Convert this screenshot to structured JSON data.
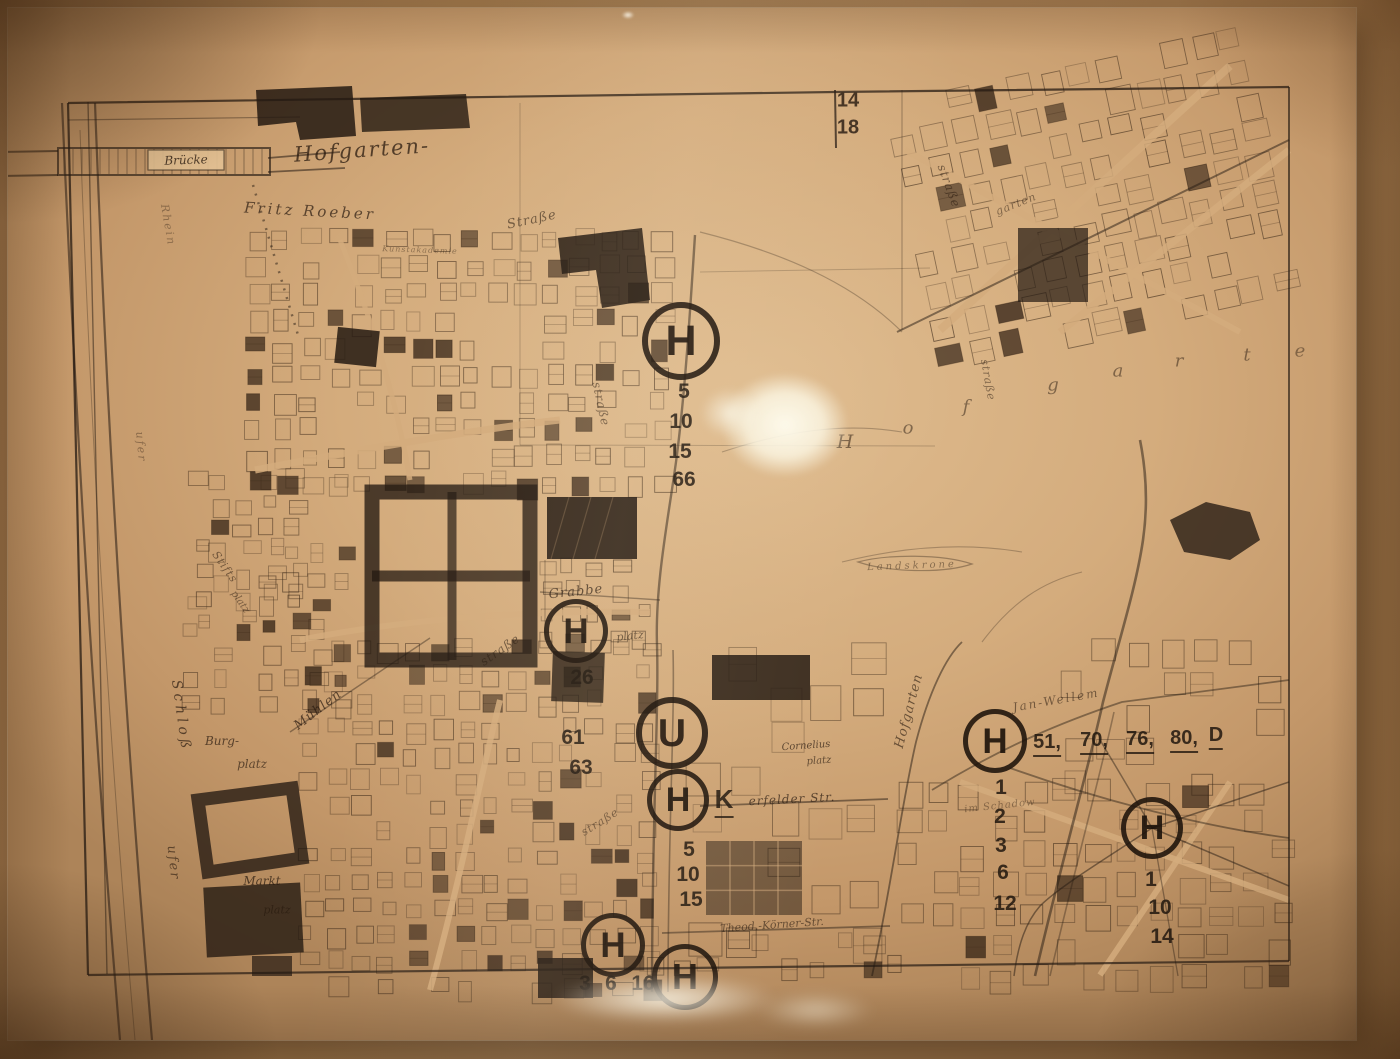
{
  "photo": {
    "colors": {
      "backdrop": "#b08757",
      "paper": "#d4ac7d",
      "paper_light": "#e2c093",
      "ink": "#241a12",
      "ink_faint": "#3a2818",
      "glare": "#fdf8e8"
    }
  },
  "map": {
    "sheet_corner_numbers": [
      "14",
      "18"
    ],
    "stops": [
      {
        "id": "h-hofgarten-north",
        "sym": "H",
        "x": 681,
        "y": 341,
        "r": 33,
        "lines": [
          {
            "t": "5",
            "x": 684,
            "y": 392
          },
          {
            "t": "10",
            "x": 681,
            "y": 422
          },
          {
            "t": "15",
            "x": 680,
            "y": 452
          },
          {
            "t": "66",
            "x": 684,
            "y": 480
          }
        ]
      },
      {
        "id": "h-grabbeplatz",
        "sym": "H",
        "x": 576,
        "y": 631,
        "r": 27,
        "lines": [
          {
            "t": "26",
            "x": 582,
            "y": 678
          },
          {
            "t": "61",
            "x": 573,
            "y": 738
          },
          {
            "t": "63",
            "x": 581,
            "y": 768
          }
        ]
      },
      {
        "id": "u-heinrich-heine-allee",
        "sym": "U",
        "x": 672,
        "y": 733,
        "r": 30,
        "lines": []
      },
      {
        "id": "h-elberfelder-str",
        "sym": "H",
        "x": 678,
        "y": 800,
        "r": 26,
        "lines": [
          {
            "t": "K",
            "x": 724,
            "y": 801,
            "u": true,
            "s": 26
          },
          {
            "t": "5",
            "x": 689,
            "y": 850
          },
          {
            "t": "10",
            "x": 688,
            "y": 875
          },
          {
            "t": "15",
            "x": 691,
            "y": 900
          }
        ]
      },
      {
        "id": "h-jan-wellem",
        "sym": "H",
        "x": 995,
        "y": 741,
        "r": 27,
        "lines": [
          {
            "t": "51,",
            "x": 1047,
            "y": 744,
            "u": true,
            "s": 20
          },
          {
            "t": "70,",
            "x": 1094,
            "y": 742,
            "u": true,
            "s": 20
          },
          {
            "t": "76,",
            "x": 1140,
            "y": 741,
            "u": true,
            "s": 20
          },
          {
            "t": "80,",
            "x": 1184,
            "y": 740,
            "u": true,
            "s": 20
          },
          {
            "t": "D",
            "x": 1216,
            "y": 737,
            "u": true,
            "s": 20
          },
          {
            "t": "1",
            "x": 1001,
            "y": 788
          },
          {
            "t": "2",
            "x": 1000,
            "y": 817
          },
          {
            "t": "3",
            "x": 1001,
            "y": 846
          },
          {
            "t": "6",
            "x": 1003,
            "y": 873
          },
          {
            "t": "12",
            "x": 1005,
            "y": 904
          }
        ]
      },
      {
        "id": "h-schadowstrasse",
        "sym": "H",
        "x": 1152,
        "y": 828,
        "r": 26,
        "lines": [
          {
            "t": "1",
            "x": 1151,
            "y": 880
          },
          {
            "t": "10",
            "x": 1160,
            "y": 908
          },
          {
            "t": "14",
            "x": 1162,
            "y": 937
          }
        ]
      },
      {
        "id": "h-south-west",
        "sym": "H",
        "x": 613,
        "y": 945,
        "r": 27,
        "lines": [
          {
            "t": "3",
            "x": 585,
            "y": 984
          },
          {
            "t": "6",
            "x": 611,
            "y": 984
          },
          {
            "t": "16",
            "x": 643,
            "y": 984
          }
        ]
      },
      {
        "id": "h-south-east",
        "sym": "H",
        "x": 685,
        "y": 977,
        "r": 28,
        "lines": []
      }
    ],
    "labels": [
      {
        "t": "Brücke",
        "x": 186,
        "y": 160,
        "s": 12,
        "r": -2,
        "o": 0.8
      },
      {
        "t": "Hofgarten-",
        "x": 362,
        "y": 150,
        "s": 21,
        "r": -4,
        "o": 0.75,
        "ls": 2
      },
      {
        "t": "Fritz Roeber",
        "x": 310,
        "y": 211,
        "s": 15,
        "r": 3,
        "o": 0.7,
        "ls": 3
      },
      {
        "t": "Straße",
        "x": 532,
        "y": 220,
        "s": 13,
        "r": -12,
        "o": 0.6,
        "ls": 1
      },
      {
        "t": "straße",
        "x": 601,
        "y": 404,
        "s": 12,
        "r": 78,
        "o": 0.55,
        "ls": 1
      },
      {
        "t": "Grabbe",
        "x": 576,
        "y": 592,
        "s": 13,
        "r": -6,
        "o": 0.7,
        "ls": 1
      },
      {
        "t": "platz",
        "x": 630,
        "y": 636,
        "s": 11,
        "r": -6,
        "o": 0.6
      },
      {
        "t": "Mühlen",
        "x": 318,
        "y": 710,
        "s": 13,
        "r": -38,
        "o": 0.7,
        "ls": 1
      },
      {
        "t": "straße",
        "x": 500,
        "y": 650,
        "s": 12,
        "r": -35,
        "o": 0.6,
        "ls": 1
      },
      {
        "t": "Burg-",
        "x": 222,
        "y": 741,
        "s": 12,
        "r": 0,
        "o": 0.7
      },
      {
        "t": "platz",
        "x": 252,
        "y": 764,
        "s": 12,
        "r": 0,
        "o": 0.65
      },
      {
        "t": "Markt",
        "x": 262,
        "y": 881,
        "s": 12,
        "r": 0,
        "o": 0.72
      },
      {
        "t": "platz",
        "x": 277,
        "y": 910,
        "s": 11,
        "r": 0,
        "o": 0.68
      },
      {
        "t": "Schloß",
        "x": 181,
        "y": 716,
        "s": 14,
        "r": 82,
        "o": 0.7,
        "ls": 4
      },
      {
        "t": "ufer",
        "x": 173,
        "y": 863,
        "s": 13,
        "r": 84,
        "o": 0.62,
        "ls": 2
      },
      {
        "t": "Stifts",
        "x": 225,
        "y": 567,
        "s": 11,
        "r": 55,
        "o": 0.55,
        "ls": 1
      },
      {
        "t": "platz",
        "x": 240,
        "y": 602,
        "s": 10,
        "r": 55,
        "o": 0.5
      },
      {
        "t": "ufer",
        "x": 141,
        "y": 447,
        "s": 11,
        "r": 85,
        "o": 0.4,
        "ls": 2
      },
      {
        "t": "Rhein",
        "x": 168,
        "y": 225,
        "s": 11,
        "r": 80,
        "o": 0.38,
        "ls": 2
      },
      {
        "t": "H",
        "x": 845,
        "y": 442,
        "s": 19,
        "r": 0,
        "o": 0.55
      },
      {
        "t": "o",
        "x": 908,
        "y": 428,
        "s": 18,
        "r": 0,
        "o": 0.5
      },
      {
        "t": "f",
        "x": 966,
        "y": 407,
        "s": 18,
        "r": 0,
        "o": 0.5
      },
      {
        "t": "g",
        "x": 1053,
        "y": 385,
        "s": 18,
        "r": 0,
        "o": 0.5
      },
      {
        "t": "a",
        "x": 1118,
        "y": 371,
        "s": 18,
        "r": 0,
        "o": 0.5
      },
      {
        "t": "r",
        "x": 1179,
        "y": 361,
        "s": 18,
        "r": 0,
        "o": 0.5
      },
      {
        "t": "t",
        "x": 1247,
        "y": 355,
        "s": 18,
        "r": 0,
        "o": 0.5
      },
      {
        "t": "e",
        "x": 1300,
        "y": 351,
        "s": 18,
        "r": 0,
        "o": 0.45
      },
      {
        "t": "Landskrone",
        "x": 912,
        "y": 566,
        "s": 10,
        "r": -2,
        "o": 0.45,
        "ls": 3
      },
      {
        "t": "Hofgarten",
        "x": 909,
        "y": 711,
        "s": 13,
        "r": -75,
        "o": 0.62,
        "ls": 1
      },
      {
        "t": "Jan-Wellem",
        "x": 1056,
        "y": 700,
        "s": 12,
        "r": -10,
        "o": 0.55,
        "ls": 2
      },
      {
        "t": "Cornelius",
        "x": 806,
        "y": 746,
        "s": 10,
        "r": -4,
        "o": 0.7
      },
      {
        "t": "platz",
        "x": 819,
        "y": 761,
        "s": 10,
        "r": -4,
        "o": 0.65
      },
      {
        "t": "erfelder Str.",
        "x": 792,
        "y": 799,
        "s": 12,
        "r": -3,
        "o": 0.7,
        "ls": 1
      },
      {
        "t": "straße",
        "x": 600,
        "y": 822,
        "s": 11,
        "r": -32,
        "o": 0.55,
        "ls": 1
      },
      {
        "t": "im Schadow",
        "x": 1000,
        "y": 806,
        "s": 10,
        "r": -6,
        "o": 0.42,
        "ls": 1
      },
      {
        "t": "Theod.-Körner-Str.",
        "x": 772,
        "y": 925,
        "s": 11,
        "r": -4,
        "o": 0.6
      },
      {
        "t": "straße",
        "x": 949,
        "y": 186,
        "s": 12,
        "r": 70,
        "o": 0.55,
        "ls": 1
      },
      {
        "t": "garten",
        "x": 1016,
        "y": 204,
        "s": 11,
        "r": -22,
        "o": 0.5,
        "ls": 1
      },
      {
        "t": "straße",
        "x": 988,
        "y": 380,
        "s": 11,
        "r": 80,
        "o": 0.5,
        "ls": 1
      },
      {
        "t": "Kunstakademie",
        "x": 420,
        "y": 250,
        "s": 8,
        "r": 2,
        "o": 0.42,
        "ls": 1
      },
      {
        "t": "14",
        "x": 848,
        "y": 101,
        "s": 20,
        "r": 0,
        "o": 0.85,
        "f": "sans"
      },
      {
        "t": "18",
        "x": 848,
        "y": 128,
        "s": 20,
        "r": 0,
        "o": 0.85,
        "f": "sans"
      }
    ],
    "block_regions": [
      {
        "name": "altstadt-north",
        "x": 248,
        "y": 232,
        "w": 408,
        "h": 246,
        "cell": 27,
        "density": 0.8,
        "fill_chance": 0.17
      },
      {
        "name": "altstadt-west",
        "x": 186,
        "y": 472,
        "w": 162,
        "h": 226,
        "cell": 25,
        "density": 0.72,
        "fill_chance": 0.14
      },
      {
        "name": "altstadt-south",
        "x": 302,
        "y": 642,
        "w": 356,
        "h": 344,
        "cell": 26,
        "density": 0.82,
        "fill_chance": 0.18
      },
      {
        "name": "grabbe-quarter",
        "x": 540,
        "y": 560,
        "w": 120,
        "h": 92,
        "cell": 24,
        "density": 0.6,
        "fill_chance": 0.1
      },
      {
        "name": "koenigsallee-blocks",
        "x": 690,
        "y": 645,
        "w": 185,
        "h": 288,
        "cell": 40,
        "density": 0.55,
        "fill_chance": 0.05
      },
      {
        "name": "northeast-grid",
        "x": 910,
        "y": 66,
        "w": 350,
        "h": 262,
        "cell": 31,
        "density": 0.78,
        "fill_chance": 0.06,
        "rot": -12
      },
      {
        "name": "southeast-grid",
        "x": 900,
        "y": 782,
        "w": 390,
        "h": 192,
        "cell": 31,
        "density": 0.72,
        "fill_chance": 0.07
      },
      {
        "name": "east-mid-houses",
        "x": 1062,
        "y": 642,
        "w": 226,
        "h": 138,
        "cell": 33,
        "density": 0.45,
        "fill_chance": 0.05
      },
      {
        "name": "south-bottom-row",
        "x": 620,
        "y": 932,
        "w": 278,
        "h": 42,
        "cell": 27,
        "density": 0.6,
        "fill_chance": 0.1
      },
      {
        "name": "stift-quarter",
        "x": 196,
        "y": 540,
        "w": 120,
        "h": 110,
        "cell": 24,
        "density": 0.6,
        "fill_chance": 0.12
      }
    ]
  }
}
